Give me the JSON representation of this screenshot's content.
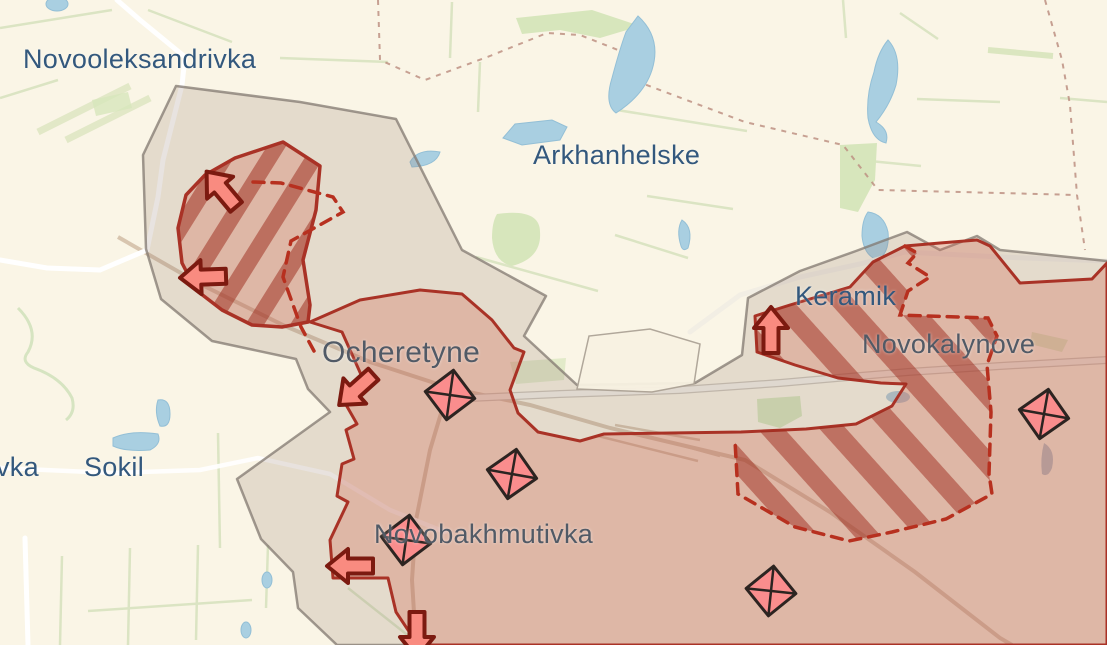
{
  "labels": {
    "novooleksandrivka": {
      "text": "Novooleksandrivka",
      "status": "free",
      "x": 23,
      "y": 44
    },
    "arkhanhelske": {
      "text": "Arkhanhelske",
      "status": "free",
      "x": 533,
      "y": 140
    },
    "keramik": {
      "text": "Keramik",
      "status": "free",
      "x": 795,
      "y": 281
    },
    "novokalynove": {
      "text": "Novokalynove",
      "status": "occupied",
      "x": 862,
      "y": 329
    },
    "ocheretyne": {
      "text": "Ocheretyne",
      "status": "occupied",
      "x": 322,
      "y": 336
    },
    "sokil": {
      "text": "Sokil",
      "status": "free",
      "x": 84,
      "y": 452
    },
    "vka_partial": {
      "text": "vka",
      "status": "free",
      "x": -4,
      "y": 452
    },
    "novobakhmutivka": {
      "text": "Novobakhmutivka",
      "status": "occupied",
      "x": 374,
      "y": 519
    }
  },
  "markers": {
    "combat_diamonds": [
      {
        "x": 450,
        "y": 395
      },
      {
        "x": 512,
        "y": 474
      },
      {
        "x": 406,
        "y": 540
      },
      {
        "x": 771,
        "y": 591
      },
      {
        "x": 1044,
        "y": 414
      }
    ],
    "advance_arrows": [
      {
        "x": 222,
        "y": 190,
        "direction": "northwest"
      },
      {
        "x": 204,
        "y": 277,
        "direction": "west"
      },
      {
        "x": 357,
        "y": 389,
        "direction": "southwest"
      },
      {
        "x": 771,
        "y": 331,
        "direction": "north"
      },
      {
        "x": 351,
        "y": 566,
        "direction": "west"
      },
      {
        "x": 417,
        "y": 634,
        "direction": "south"
      }
    ]
  },
  "regions": {
    "occupied": {
      "style": "solid-border pink fill",
      "fill": "#f0cfc0",
      "border": "#a93226"
    },
    "gray_zone": {
      "style": "gray-border taupe fill",
      "fill": "#e7dcd3",
      "border": "#8d827c"
    },
    "claimed_hatched": {
      "style": "diagonal stripes",
      "stripe": "#b8503f"
    },
    "claimed_dashed": {
      "style": "dashed red border",
      "border": "#b7301f"
    }
  },
  "palette": {
    "background": "#faf5e6",
    "water": "#a9cfe1",
    "forest": "#d7e6bc",
    "field_line": "#d6e2bd",
    "road": "#ffffff",
    "railway": "#d4c0a8",
    "admin_boundary": "#bd9183",
    "arrow_fill": "#f98b80",
    "arrow_outline": "#7c1a10",
    "diamond_fill": "#fa8d8d",
    "diamond_outline": "#2c2421",
    "label_blue": "#33587d",
    "label_gray": "#515a66"
  }
}
